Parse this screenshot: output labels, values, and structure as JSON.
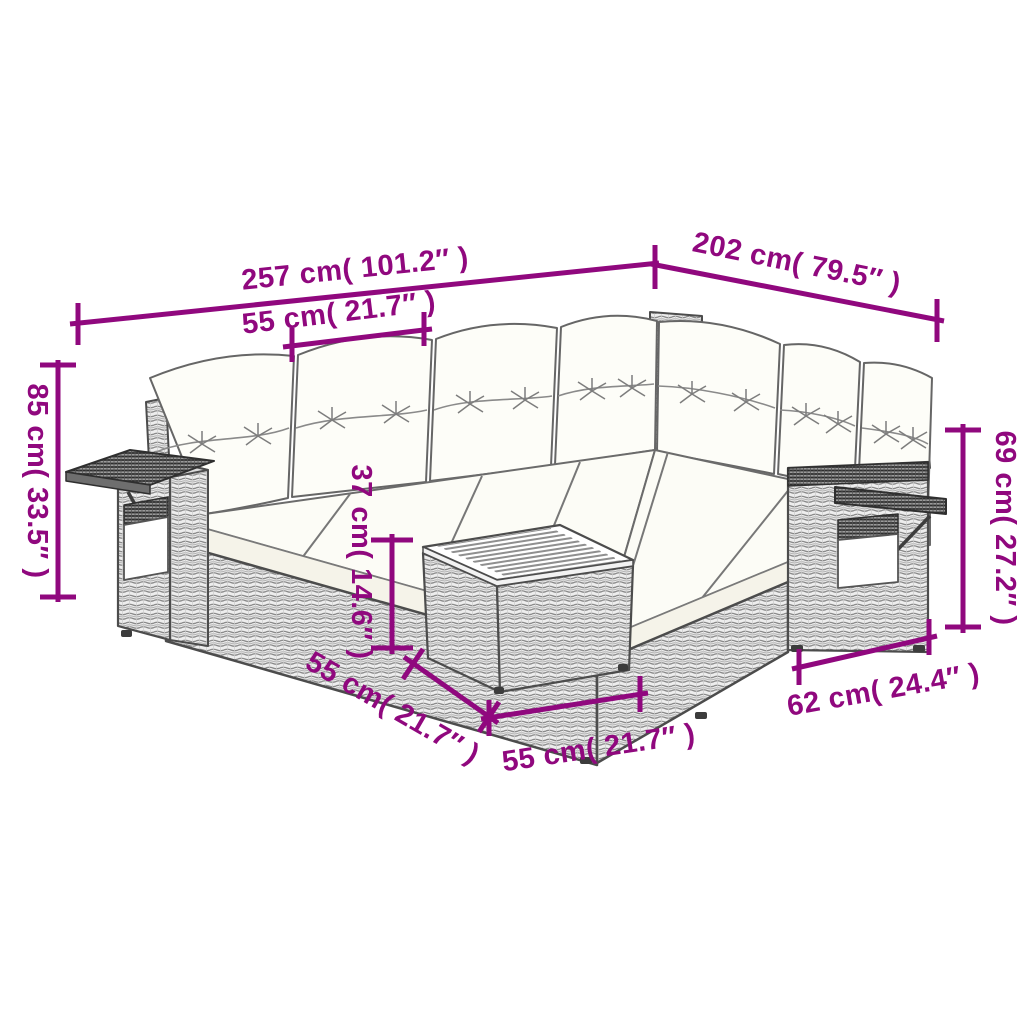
{
  "page": {
    "background": "#ffffff"
  },
  "diagram": {
    "kind": "furniture-dimension-diagram",
    "subject": "Rattan corner garden sofa set with cushions, fold-out side trays and slatted-top footstool table",
    "style": {
      "dimension_color": "#90087E",
      "outline_color": "#4c4c4c",
      "cushion_color": "#fdfdf8",
      "wicker_base": "#ededed"
    },
    "dimensions": {
      "sofa_long_side": {
        "label": "257 cm( 101.2″ )",
        "cm": 257,
        "inches": 101.2,
        "position": "top-left-slanted"
      },
      "sofa_short_side": {
        "label": "202 cm( 79.5″ )",
        "cm": 202,
        "inches": 79.5,
        "position": "top-right-slanted"
      },
      "seat_module_width": {
        "label": "55 cm( 21.7″ )",
        "cm": 55,
        "inches": 21.7,
        "position": "upper-middle"
      },
      "overall_height": {
        "label": "85 cm( 33.5″ )",
        "cm": 85,
        "inches": 33.5,
        "position": "left-vertical"
      },
      "backrest_height": {
        "label": "69 cm( 27.2″ )",
        "cm": 69,
        "inches": 27.2,
        "position": "right-vertical"
      },
      "seat_height": {
        "label": "37 cm( 14.6″ )",
        "cm": 37,
        "inches": 14.6,
        "position": "center-vertical"
      },
      "table_depth": {
        "label": "55 cm( 21.7″ )",
        "cm": 55,
        "inches": 21.7,
        "position": "bottom-diagonal"
      },
      "table_width": {
        "label": "55 cm( 21.7″ )",
        "cm": 55,
        "inches": 21.7,
        "position": "bottom-horizontal"
      },
      "arm_module_depth": {
        "label": "62 cm( 24.4″ )",
        "cm": 62,
        "inches": 24.4,
        "position": "bottom-right"
      }
    }
  }
}
